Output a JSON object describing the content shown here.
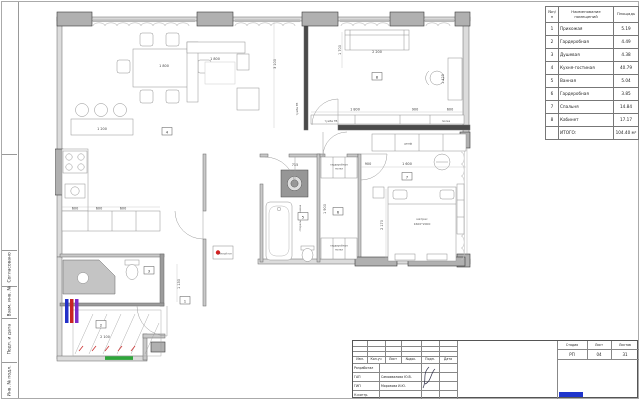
{
  "sheet": {
    "left_margin_labels": [
      "Согласовано",
      "Взам. инв. №",
      "Подп. и дата",
      "Инв. № подл."
    ]
  },
  "room_table": {
    "col_num": "№п/п",
    "col_name": "Наименование помещений",
    "col_area": "Площадь",
    "rows": [
      {
        "num": "1",
        "name": "Прихожая",
        "area": "5.19"
      },
      {
        "num": "2",
        "name": "Гардеробная",
        "area": "4.49"
      },
      {
        "num": "3",
        "name": "Душевая",
        "area": "4.38"
      },
      {
        "num": "4",
        "name": "Кухня-гостиная",
        "area": "40.79"
      },
      {
        "num": "5",
        "name": "Ванная",
        "area": "5.04"
      },
      {
        "num": "6",
        "name": "Гардеробная",
        "area": "3.85"
      },
      {
        "num": "7",
        "name": "Спальня",
        "area": "14.84"
      },
      {
        "num": "8",
        "name": "Кабинет",
        "area": "17.17"
      }
    ],
    "total_label": "ИТОГО:",
    "total_value": "104.40 м²"
  },
  "plan": {
    "dims": [
      "1 800",
      "1 800",
      "2 200",
      "1 700",
      "3 100",
      "1 425",
      "1 800",
      "900",
      "600",
      "900",
      "1 600",
      "2 170",
      "600",
      "600",
      "600",
      "1 200",
      "2 100",
      "1 130",
      "715",
      "1 900"
    ],
    "labels": {
      "tv_unit": "тумба ТВ",
      "tv_unit_wall": "тумба ТВ",
      "shelf": "полка",
      "mattress1": "матрас",
      "mattress2": "1600*2000",
      "wardrobe1a": "гардеробные",
      "wardrobe1b": "полки",
      "wardrobe2a": "гардеробные",
      "wardrobe2b": "полки",
      "washer": "стиральная машина",
      "closet": "шкаф",
      "warm_floor": "тёплый пол"
    },
    "room_markers": [
      "1",
      "2",
      "3",
      "4",
      "5",
      "6",
      "7",
      "8"
    ]
  },
  "title_block": {
    "rev_headers": [
      "Изм.",
      "Кол.уч",
      "Лист",
      "№док.",
      "Подп.",
      "Дата"
    ],
    "rows": [
      {
        "role": "Разработал",
        "name": ""
      },
      {
        "role": "ГАП",
        "name": "Самохвалова Ю.В."
      },
      {
        "role": "ГИП",
        "name": "Морозова И.Ю."
      },
      {
        "role": "Н.контр.",
        "name": ""
      }
    ],
    "stage_label": "Стадия",
    "sheet_label": "Лист",
    "sheets_label": "Листов",
    "stage": "РП",
    "sheet_no": "04",
    "sheets_total": "31"
  },
  "colors": {
    "entry_marker": "#2ea63a",
    "bar_blue": "#2330c8",
    "bar_red": "#c82323",
    "bar_purple": "#7a2bc8",
    "warm_floor_dot": "#d42020",
    "logo": "#1f35cc"
  }
}
